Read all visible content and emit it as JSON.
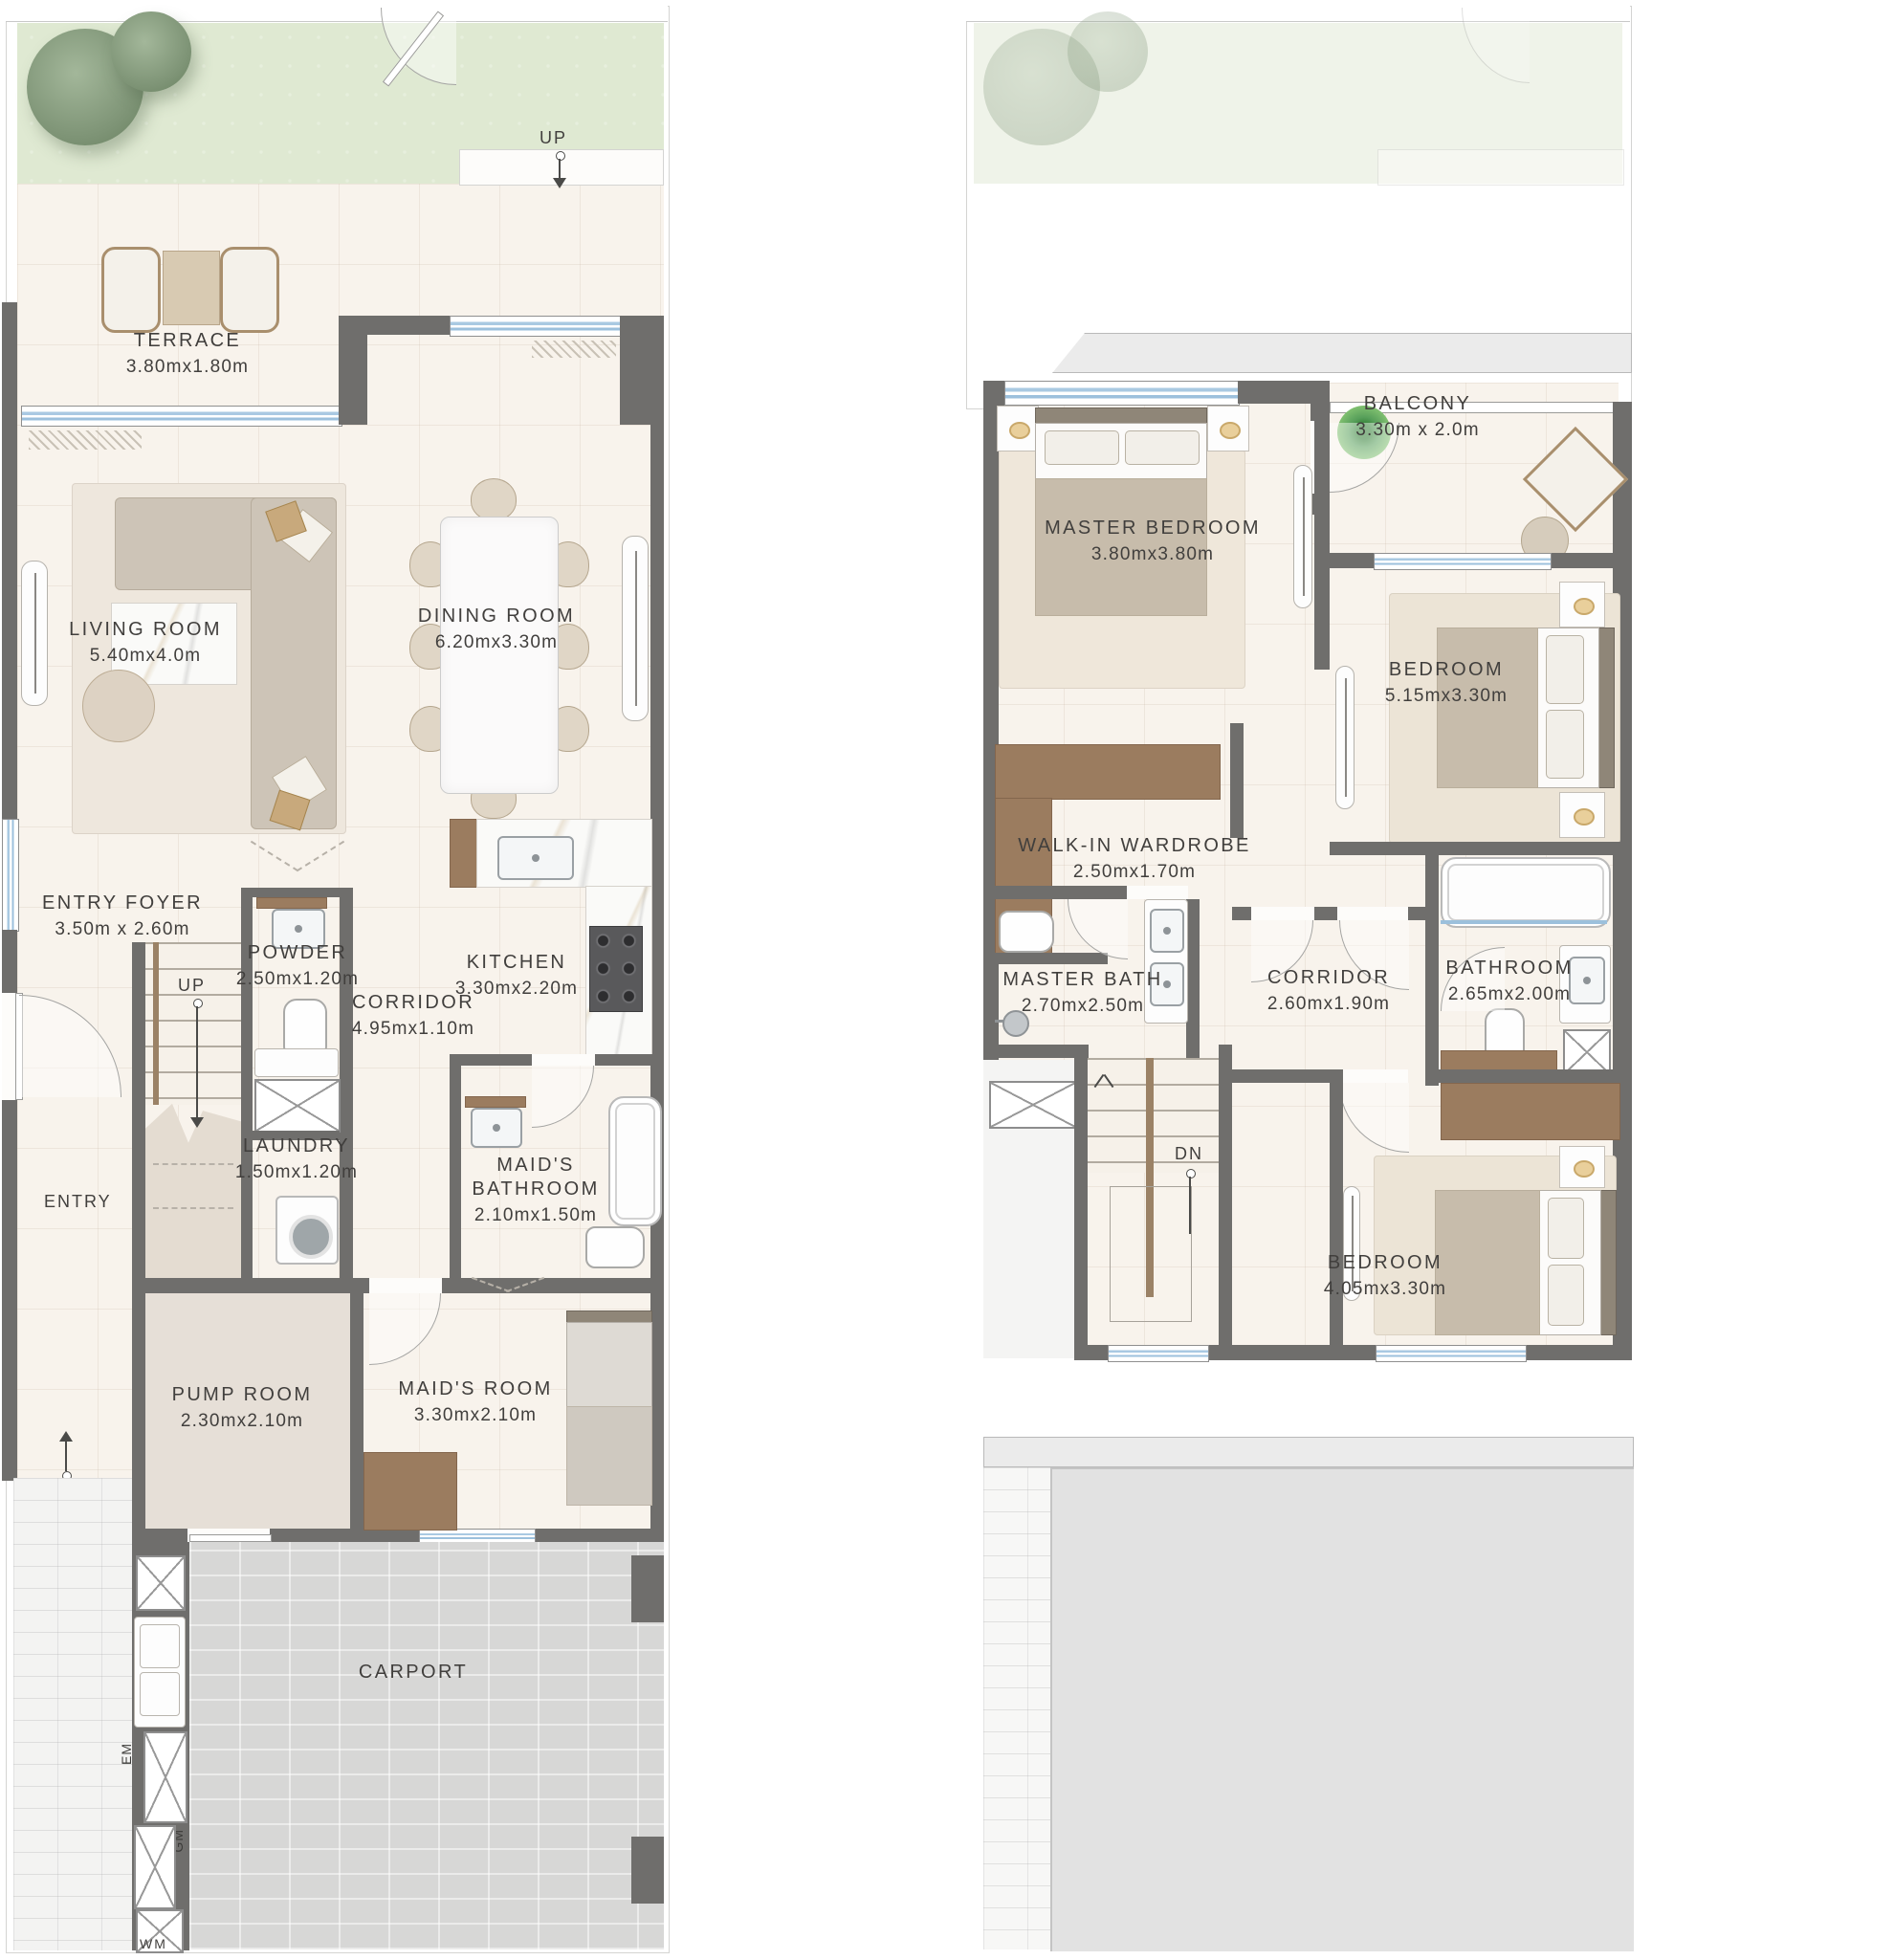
{
  "plan1": {
    "labels": {
      "up_garden": "UP",
      "up_stairs": "UP",
      "up_carport": "UP",
      "entry": "ENTRY",
      "carport": "CARPORT",
      "em": "EM",
      "gm": "GM",
      "wm": "WM"
    },
    "rooms": [
      {
        "name": "TERRACE",
        "dims": "3.80mx1.80m"
      },
      {
        "name": "LIVING ROOM",
        "dims": "5.40mx4.0m"
      },
      {
        "name": "DINING ROOM",
        "dims": "6.20mx3.30m"
      },
      {
        "name": "ENTRY FOYER",
        "dims": "3.50m x 2.60m"
      },
      {
        "name": "POWDER",
        "dims": "2.50mx1.20m"
      },
      {
        "name": "KITCHEN",
        "dims": "3.30mx2.20m"
      },
      {
        "name": "CORRIDOR",
        "dims": "4.95mx1.10m"
      },
      {
        "name": "LAUNDRY",
        "dims": "1.50mx1.20m"
      },
      {
        "name": "MAID'S BATHROOM",
        "dims": "2.10mx1.50m"
      },
      {
        "name": "PUMP ROOM",
        "dims": "2.30mx2.10m"
      },
      {
        "name": "MAID'S ROOM",
        "dims": "3.30mx2.10m"
      }
    ]
  },
  "plan2": {
    "labels": {
      "dn": "DN"
    },
    "rooms": [
      {
        "name": "BALCONY",
        "dims": "3.30m x 2.0m"
      },
      {
        "name": "MASTER BEDROOM",
        "dims": "3.80mx3.80m"
      },
      {
        "name": "BEDROOM",
        "dims": "5.15mx3.30m"
      },
      {
        "name": "WALK-IN WARDROBE",
        "dims": "2.50mx1.70m"
      },
      {
        "name": "MASTER BATH",
        "dims": "2.70mx2.50m"
      },
      {
        "name": "CORRIDOR",
        "dims": "2.60mx1.90m"
      },
      {
        "name": "BATHROOM",
        "dims": "2.65mx2.00m"
      },
      {
        "name": "BEDROOM",
        "dims": "4.05mx3.30m"
      }
    ]
  }
}
